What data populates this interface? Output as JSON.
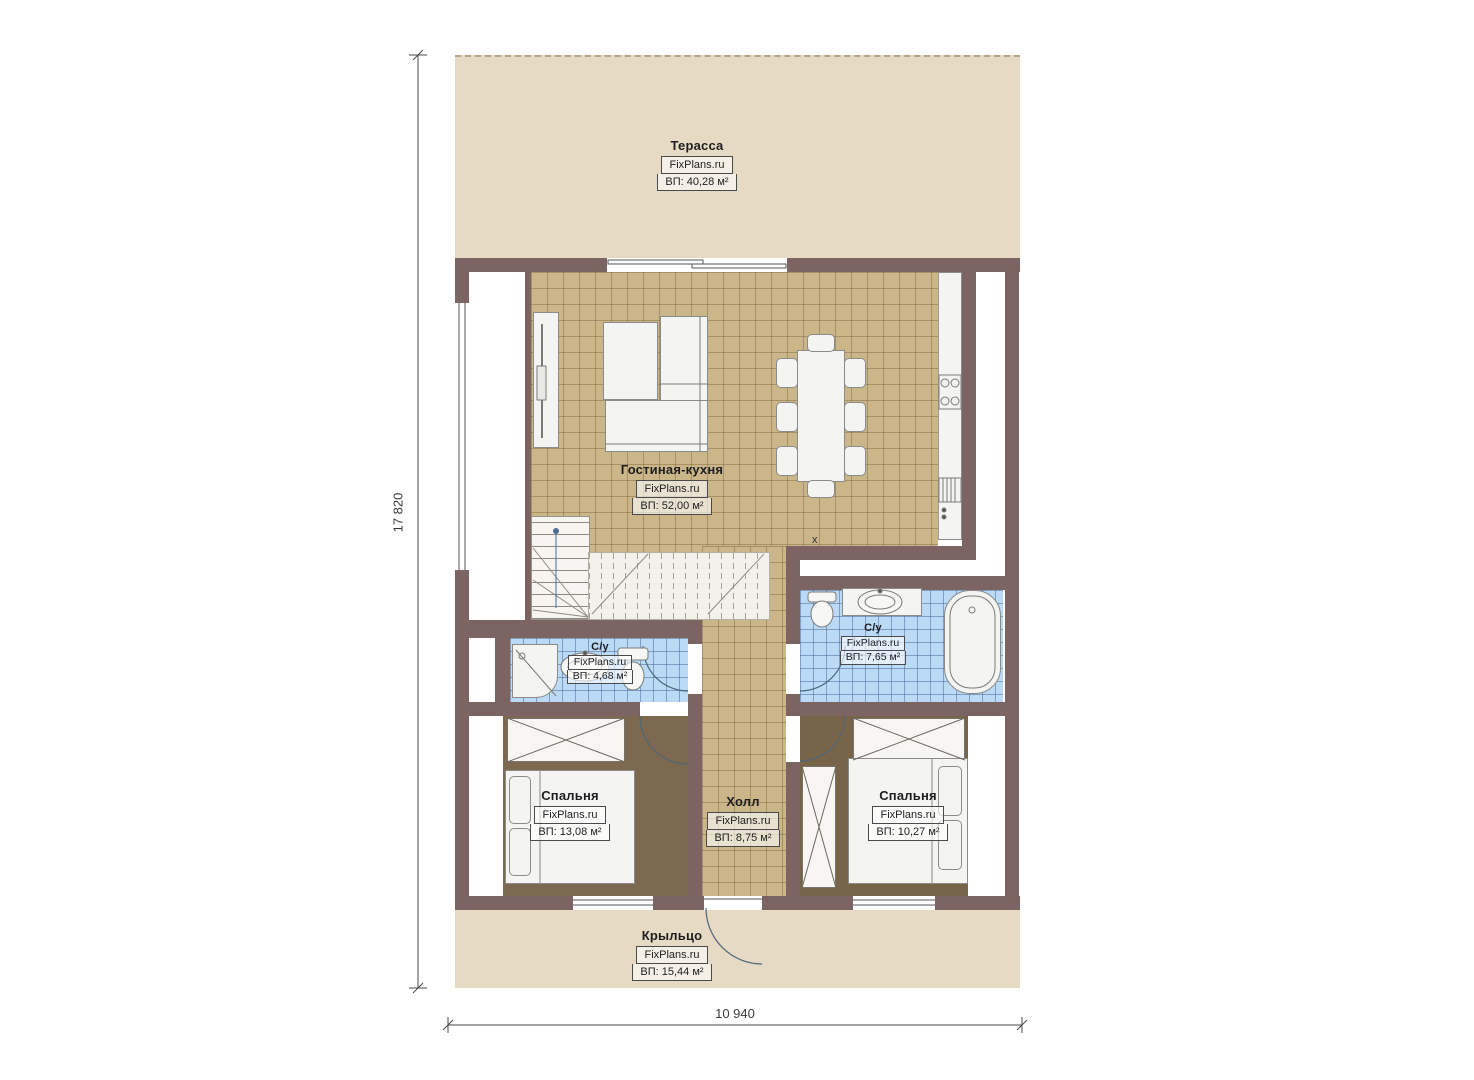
{
  "brand": "FixPlans.ru",
  "dimensions": {
    "height_label": "17 820",
    "width_label": "10 940"
  },
  "rooms": {
    "terrace": {
      "title": "Терасса",
      "brand": "FixPlans.ru",
      "area": "ВП: 40,28 м²"
    },
    "living": {
      "title": "Гостиная-кухня",
      "brand": "FixPlans.ru",
      "area": "ВП: 52,00 м²"
    },
    "bath_small": {
      "title": "С/у",
      "brand": "FixPlans.ru",
      "area": "ВП: 4,68 м²"
    },
    "bath_big": {
      "title": "С/у",
      "brand": "FixPlans.ru",
      "area": "ВП: 7,65 м²"
    },
    "bedroom_left": {
      "title": "Спальня",
      "brand": "FixPlans.ru",
      "area": "ВП: 13,08 м²"
    },
    "bedroom_right": {
      "title": "Спальня",
      "brand": "FixPlans.ru",
      "area": "ВП: 10,27 м²"
    },
    "hall": {
      "title": "Холл",
      "brand": "FixPlans.ru",
      "area": "ВП: 8,75 м²"
    },
    "porch": {
      "title": "Крыльцо",
      "brand": "FixPlans.ru",
      "area": "ВП: 15,44 м²"
    }
  },
  "misc": {
    "kitchen_mark": "x"
  },
  "colors": {
    "wall": "#7b6462",
    "terrace": "#e6dac4",
    "tile": "#cbb68a",
    "bath_tile": "#badaf6",
    "bedroom_floor": "#7d6950",
    "fixture": "#f4f4f2"
  }
}
